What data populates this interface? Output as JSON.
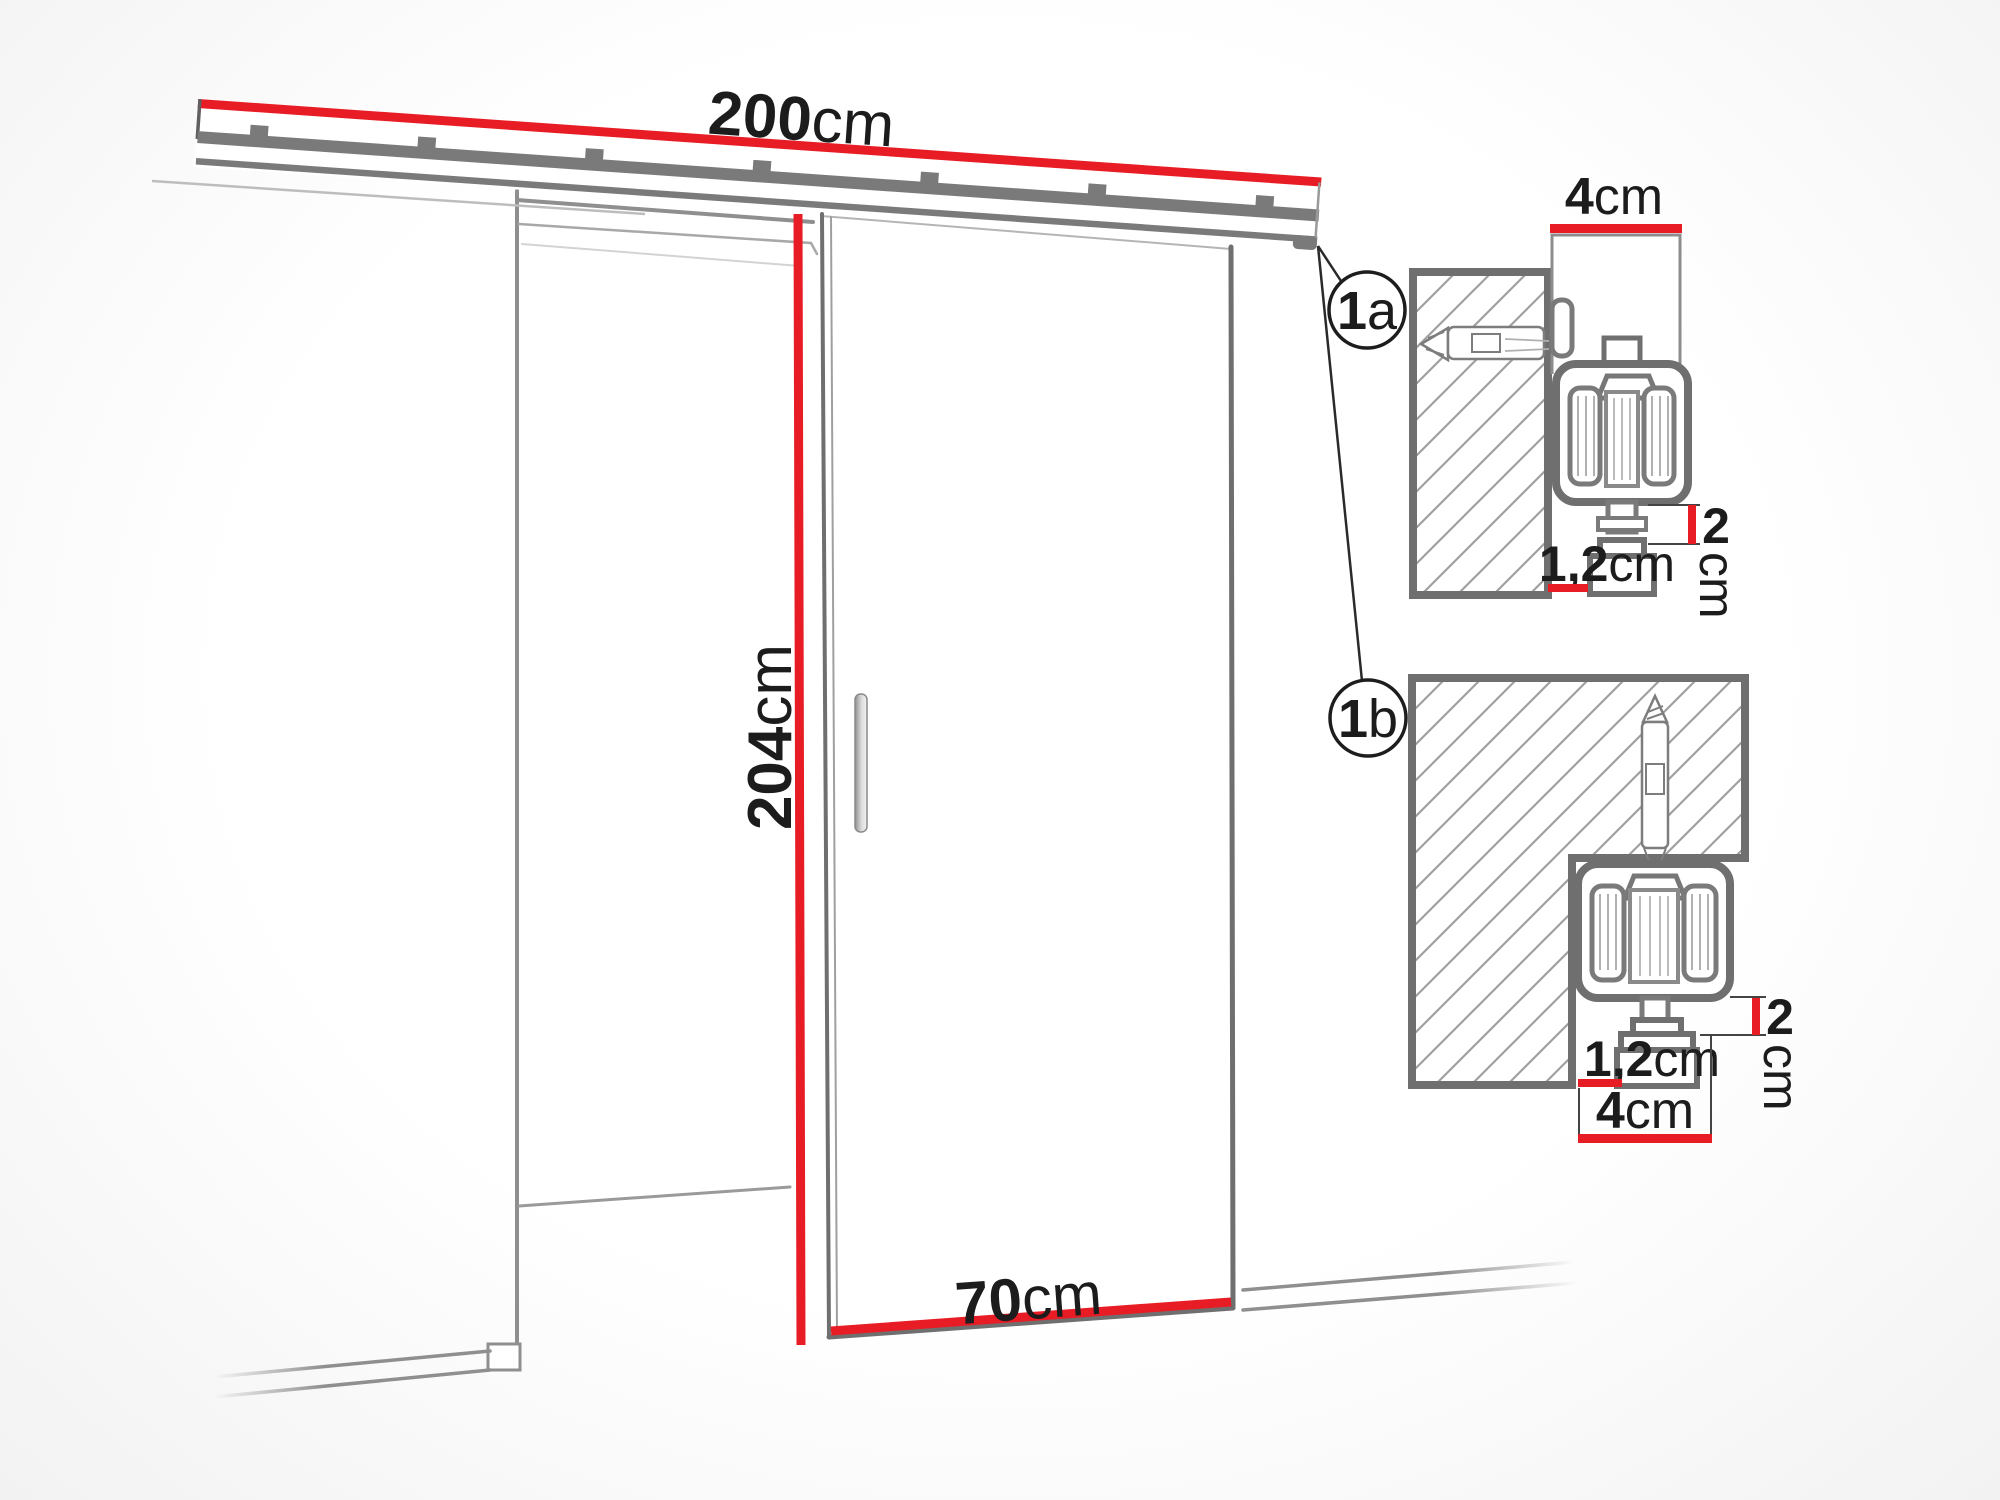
{
  "diagram": {
    "main": {
      "rail_width": {
        "value": "200",
        "unit": "cm"
      },
      "door_height": {
        "value": "204",
        "unit": "cm"
      },
      "door_width": {
        "value": "70",
        "unit": "cm"
      }
    },
    "callouts": {
      "a": {
        "number": "1",
        "letter": "a"
      },
      "b": {
        "number": "1",
        "letter": "b"
      }
    },
    "detail_a": {
      "rail_depth": {
        "value": "4",
        "unit": "cm"
      },
      "clearance": {
        "value": "2",
        "unit": "cm"
      },
      "gap": {
        "value": "1,2",
        "unit": "cm"
      }
    },
    "detail_b": {
      "clearance": {
        "value": "2",
        "unit": "cm"
      },
      "gap": {
        "value": "1,2",
        "unit": "cm"
      },
      "rail_depth": {
        "value": "4",
        "unit": "cm"
      }
    },
    "colors": {
      "accent_red": "#e81c24",
      "outline_gray": "#6f6f6f",
      "line_gray": "#8f8f8f",
      "hatch_gray": "#a0a0a0",
      "text_black": "#1c1c1c"
    }
  }
}
